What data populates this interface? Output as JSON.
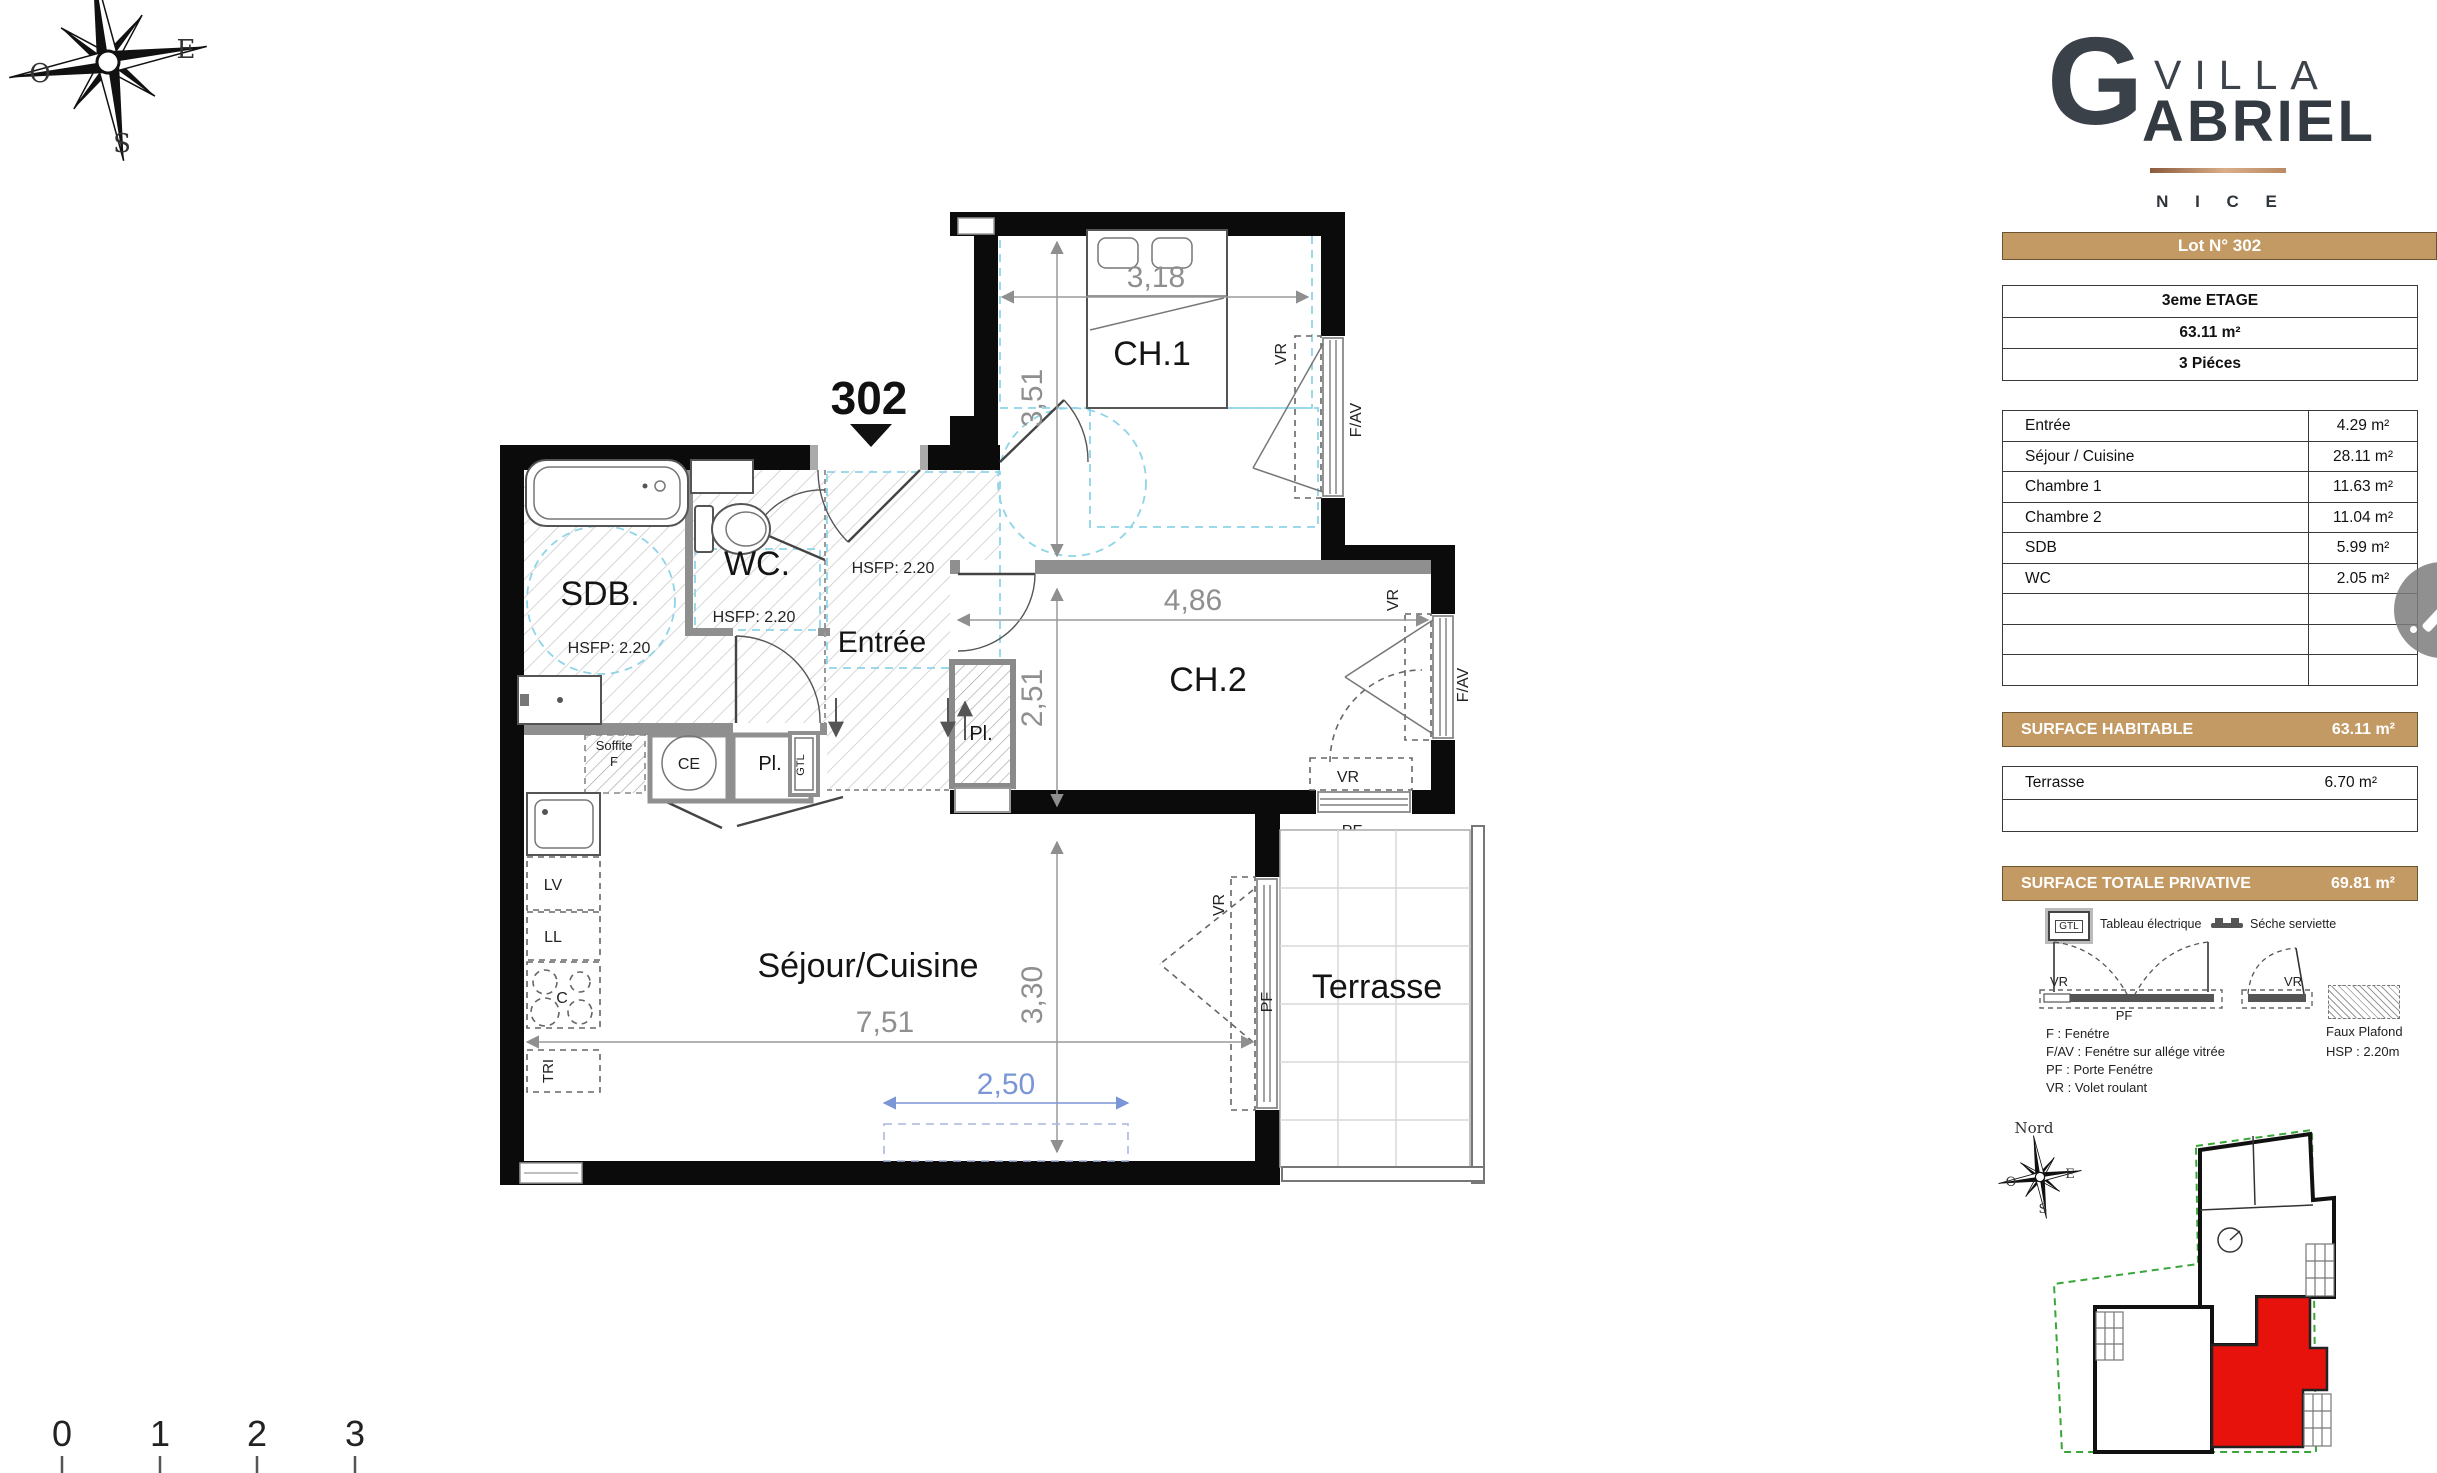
{
  "sidebar": {
    "logo": {
      "initial": "G",
      "line1": "VILLA",
      "line2": "ABRIEL",
      "city": "N I C E"
    },
    "lot_banner": "Lot N° 302",
    "info_rows": [
      "3eme ETAGE",
      "63.11 m²",
      "3 Piéces"
    ],
    "rooms": [
      {
        "label": "Entrée",
        "area": "4.29 m²"
      },
      {
        "label": "Séjour / Cuisine",
        "area": "28.11 m²"
      },
      {
        "label": "Chambre 1",
        "area": "11.63 m²"
      },
      {
        "label": "Chambre 2",
        "area": "11.04 m²"
      },
      {
        "label": "SDB",
        "area": "5.99 m²"
      },
      {
        "label": "WC",
        "area": "2.05 m²"
      }
    ],
    "surface_habitable": {
      "label": "SURFACE HABITABLE",
      "value": "63.11 m²"
    },
    "terrasse": {
      "label": "Terrasse",
      "value": "6.70 m²"
    },
    "surface_totale": {
      "label": "SURFACE TOTALE PRIVATIVE",
      "value": "69.81 m²"
    },
    "legend": {
      "gtl_icon": "GTL",
      "tableau": "Tableau électrique",
      "seche": "Séche serviette",
      "vr": "VR",
      "pf": "PF",
      "faux_plafond": "Faux Plafond",
      "hsp": "HSP : 2.20m",
      "abbr_f": "F : Fenétre",
      "abbr_fav": "F/AV : Fenétre sur allége vitrée",
      "abbr_pf": "PF : Porte Fenétre",
      "abbr_vr": "VR : Volet roulant"
    },
    "minimap": {
      "nord": "Nord",
      "e": "E",
      "o": "O",
      "s": "S"
    }
  },
  "plan": {
    "unit": "302",
    "rooms": {
      "ch1": "CH.1",
      "ch2": "CH.2",
      "wc": "WC.",
      "sdb": "SDB.",
      "entree": "Entrée",
      "sejour": "Séjour/Cuisine",
      "terrasse": "Terrasse"
    },
    "hsfp": "HSFP: 2.20",
    "dims": {
      "w_ch1": "3,18",
      "h_ch1": "3,51",
      "w_ch2": "4,86",
      "h_ch2": "2,51",
      "w_sej": "7,51",
      "h_sej": "3,30",
      "w_bay": "2,50"
    },
    "fixtures": {
      "ce": "CE",
      "pl": "Pl.",
      "gtl": "GTL",
      "lv": "LV",
      "ll": "LL",
      "c": "C",
      "tri": "TRI",
      "soffite": "Soffite",
      "f": "F"
    },
    "windows": {
      "vr": "VR",
      "pf": "PF",
      "fav": "F/AV"
    }
  },
  "compass": {
    "e": "E",
    "o": "O",
    "s": "S"
  },
  "scalebar": [
    "0",
    "1",
    "2",
    "3"
  ],
  "colors": {
    "tan": "#c49a64",
    "red": "#e8120c",
    "cyan": "#8fd4e8",
    "dim_blue": "#7b96d6",
    "green": "#3aa63a"
  }
}
